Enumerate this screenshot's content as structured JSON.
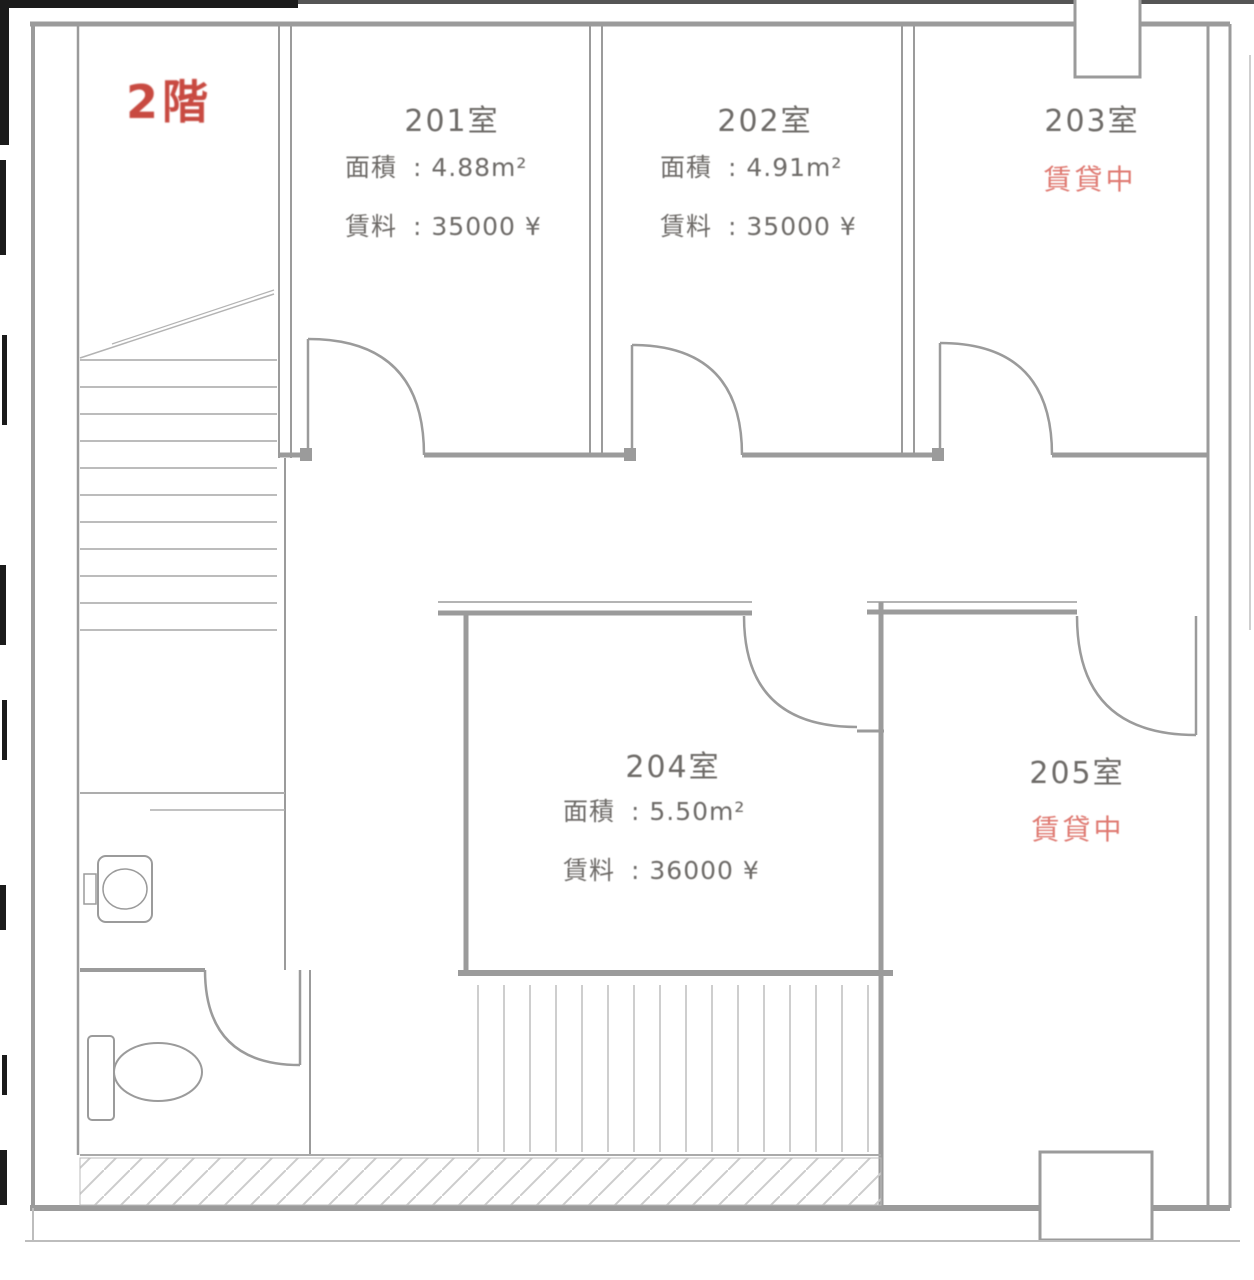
{
  "floor_label": "2階",
  "rooms": [
    {
      "id": "201",
      "name": "201室",
      "area_label": "面積",
      "area_value": ": 4.88m²",
      "rent_label": "賃料",
      "rent_value": ": 35000 ¥"
    },
    {
      "id": "202",
      "name": "202室",
      "area_label": "面積",
      "area_value": ": 4.91m²",
      "rent_label": "賃料",
      "rent_value": ": 35000 ¥"
    },
    {
      "id": "203",
      "name": "203室",
      "status": "賃貸中"
    },
    {
      "id": "204",
      "name": "204室",
      "area_label": "面積",
      "area_value": ": 5.50m²",
      "rent_label": "賃料",
      "rent_value": ": 36000 ¥"
    },
    {
      "id": "205",
      "name": "205室",
      "status": "賃貸中"
    }
  ],
  "colors": {
    "line_gray": "#9b9b9b",
    "text_gray": "#6e6b68",
    "floor_red": "#c84a41",
    "status_red": "#df7a72"
  }
}
